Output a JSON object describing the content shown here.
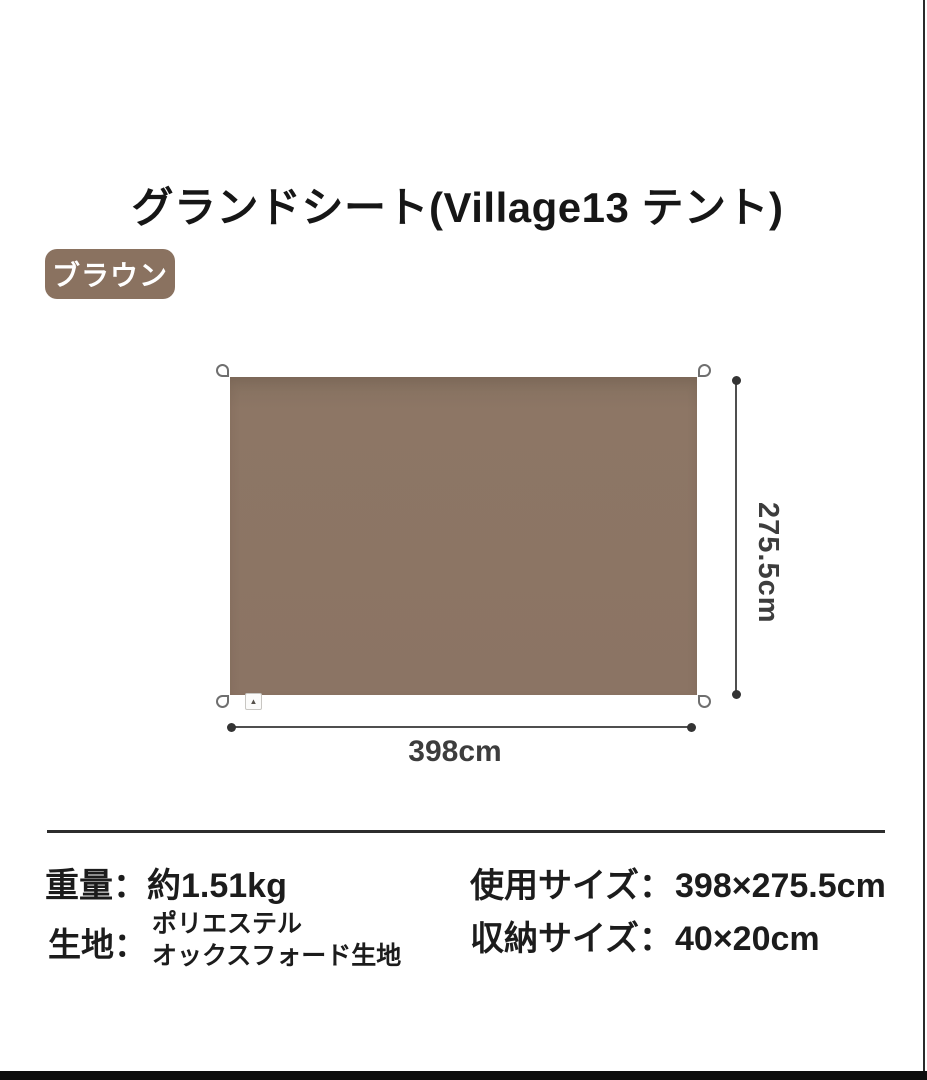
{
  "title": "グランドシート(Village13 テント)",
  "color_badge": {
    "label": "ブラウン",
    "bg_color": "#8A7260",
    "text_color": "#FFFFFF"
  },
  "diagram": {
    "sheet_color": "#8B7464",
    "height_label": "275.5cm",
    "width_label": "398cm",
    "corner_loops": 4,
    "brand_tag_glyph": "▲"
  },
  "specs": {
    "weight_label": "重量：",
    "weight_value": "約1.51kg",
    "fabric_label": "生地：",
    "fabric_value_line1": "ポリエステル",
    "fabric_value_line2": "オックスフォード生地",
    "use_size_label": "使用サイズ：",
    "use_size_value": "398×275.5cm",
    "storage_size_label": "収納サイズ：",
    "storage_size_value": "40×20cm"
  }
}
